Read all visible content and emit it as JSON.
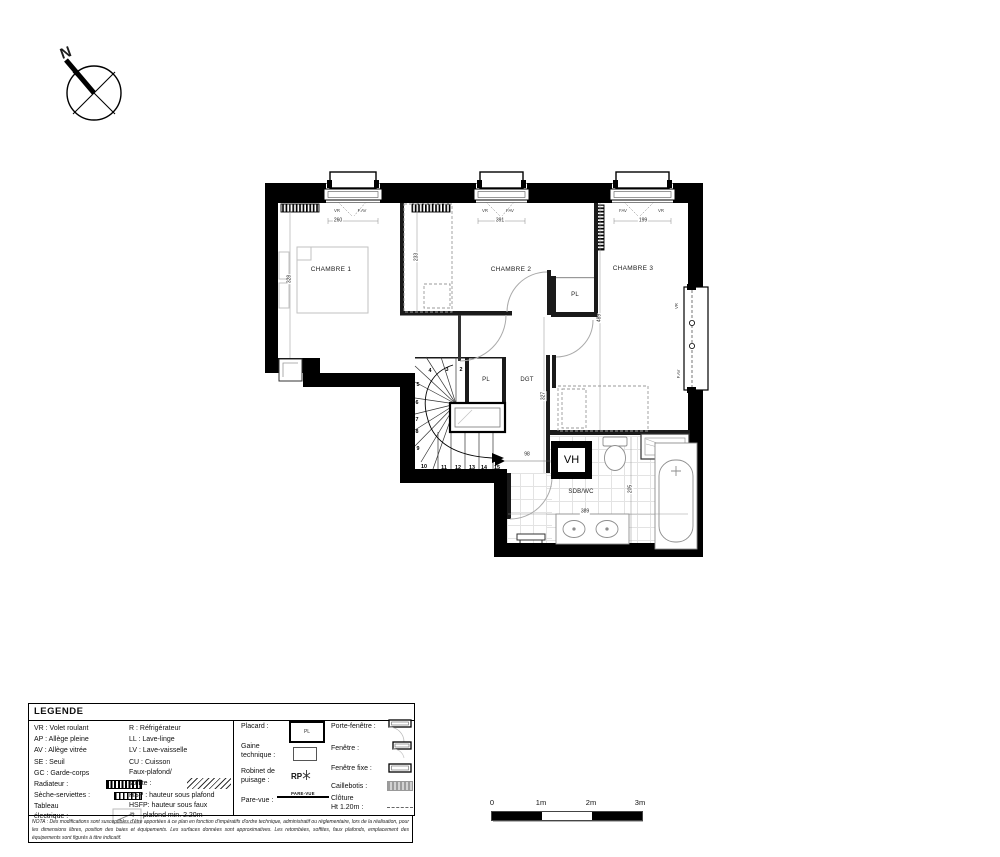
{
  "compass": {
    "north_label": "N"
  },
  "plan": {
    "rooms": {
      "chambre1": "CHAMBRE 1",
      "chambre2": "CHAMBRE 2",
      "chambre3": "CHAMBRE 3",
      "pl_chambre2": "PL",
      "pl_stairs": "PL",
      "dgt": "DGT",
      "sdb_wc": "SDB/WC",
      "vh": "VH"
    },
    "dims": {
      "window1": "260",
      "window2": "391",
      "window3": "199",
      "chambre1_depth": "328",
      "chambre2_depth": "233",
      "chambre3_depth": "489",
      "dgt_length": "327",
      "stair_width": "98",
      "sdb_depth": "205",
      "sdb_width": "389"
    },
    "window_tags": {
      "w1_vr": "VR",
      "w1_fav": "F.AV",
      "w2_vr": "VR",
      "w2_fav": "FAV",
      "w3_fav": "FAV",
      "w3_vr": "VR",
      "right_vr": "VR",
      "right_fav": "F.AV"
    },
    "stair_steps": [
      "2",
      "3",
      "4",
      "5",
      "6",
      "7",
      "8",
      "9",
      "10",
      "11",
      "12",
      "13",
      "14",
      "15"
    ]
  },
  "legend": {
    "title": "LEGENDE",
    "col1": [
      "VR : Volet roulant",
      "AP : Allège pleine",
      "AV : Allège vitrée",
      "SE : Seuil",
      "GC : Garde-corps",
      "Radiateur :",
      "Sèche-serviettes :",
      "Tableau",
      "électrique :"
    ],
    "col2": [
      "R : Réfrigérateur",
      "LL : Lave-linge",
      "LV : Lave-vaisselle",
      "CU : Cuisson",
      "Faux-plafond/",
      "soffite :",
      "HSP : hauteur sous plafond",
      "HSFP: hauteur sous faux",
      "plafond min. 2.20m"
    ],
    "col3": {
      "placard": "Placard :",
      "placard_sym": "PL",
      "gaine1": "Gaine",
      "gaine2": "technique :",
      "robinet1": "Robinet de",
      "robinet2": "puisage :",
      "rp": "RP",
      "parevue": "Pare-vue :",
      "parevue_sym": "PARE-VUE"
    },
    "col4": [
      "Porte-fenêtre :",
      "Fenêtre :",
      "Fenêtre fixe :",
      "Caillebotis :",
      "Clôture",
      "Ht 1.20m :"
    ]
  },
  "nota": "NOTA : Des modifications sont susceptibles d'être apportées à ce plan en fonction d'impératifs d'ordre technique, administratif ou réglementaire, lors de la réalisation, pour les dimensions libres, position des baies et équipements. Les surfaces données sont approximatives. Les retombées, soffites, faux plafonds, emplacement des équipements sont figurés à titre indicatif.",
  "scale": [
    "0",
    "1m",
    "2m",
    "3m"
  ]
}
